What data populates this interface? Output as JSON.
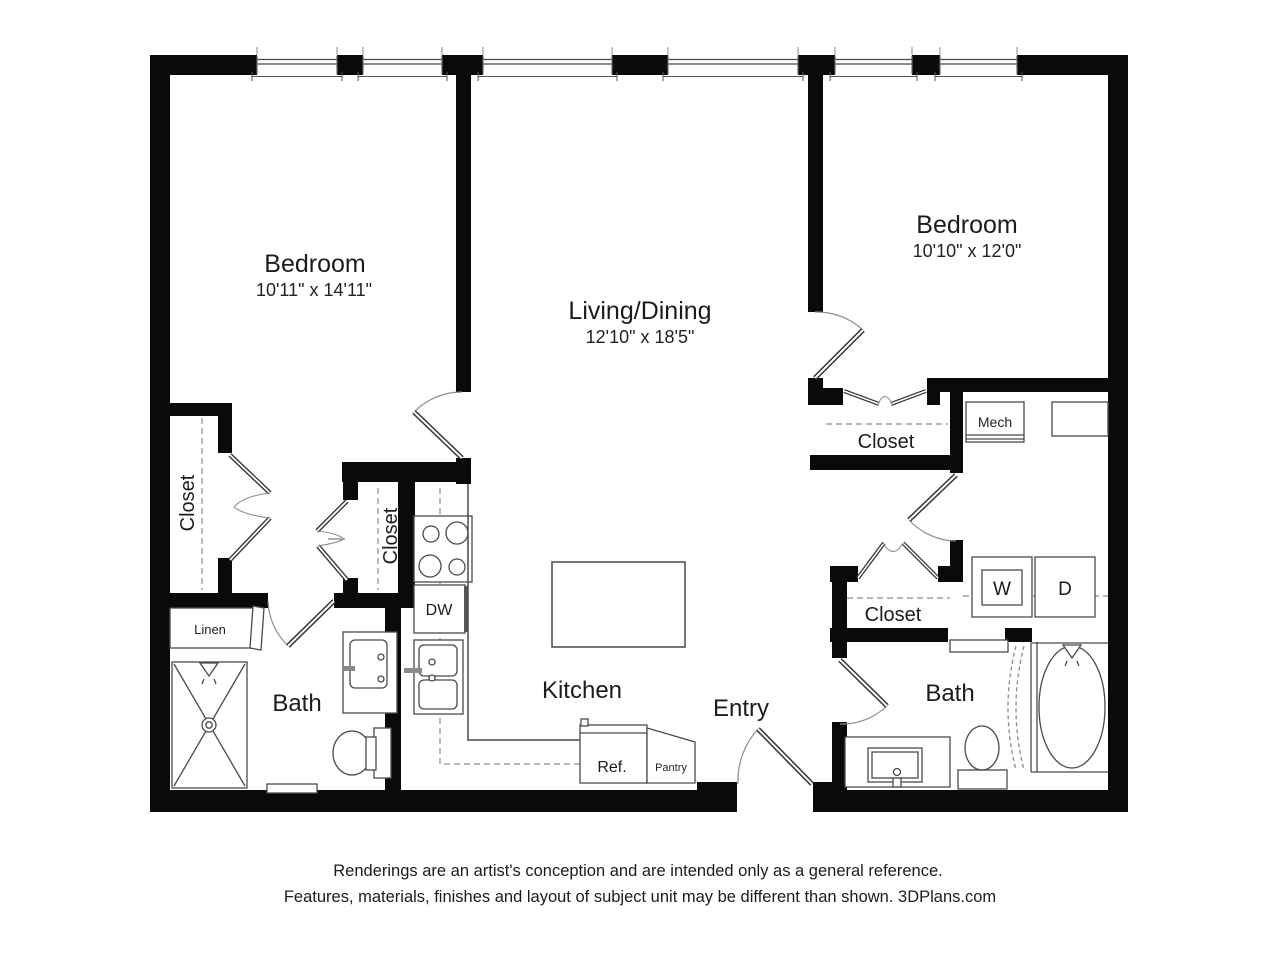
{
  "rooms": {
    "bedroom_left": {
      "name": "Bedroom",
      "dims": "10'11\" x 14'11\""
    },
    "bedroom_right": {
      "name": "Bedroom",
      "dims": "10'10\" x 12'0\""
    },
    "living_dining": {
      "name": "Living/Dining",
      "dims": "12'10\" x 18'5\""
    },
    "kitchen": {
      "name": "Kitchen"
    },
    "entry": {
      "name": "Entry"
    },
    "bath_left": {
      "name": "Bath"
    },
    "bath_right": {
      "name": "Bath"
    },
    "closet_bedroom_left": {
      "name": "Closet"
    },
    "closet_hall_left": {
      "name": "Closet"
    },
    "closet_bedroom_right": {
      "name": "Closet"
    },
    "closet_hall_right": {
      "name": "Closet"
    },
    "linen": {
      "name": "Linen"
    },
    "mech": {
      "name": "Mech"
    }
  },
  "fixtures": {
    "dishwasher": "DW",
    "refrigerator": "Ref.",
    "pantry": "Pantry",
    "washer": "W",
    "dryer": "D"
  },
  "footer": {
    "line1": "Renderings are an artist's conception and are intended only as a general reference.",
    "line2": "Features, materials, finishes and layout of subject unit may be different than shown. 3DPlans.com"
  },
  "colors": {
    "wall": "#0a0a0a",
    "fixture_line": "#4a4a4a",
    "swing_arc": "#8c8c8c",
    "text": "#1c1c1c"
  }
}
